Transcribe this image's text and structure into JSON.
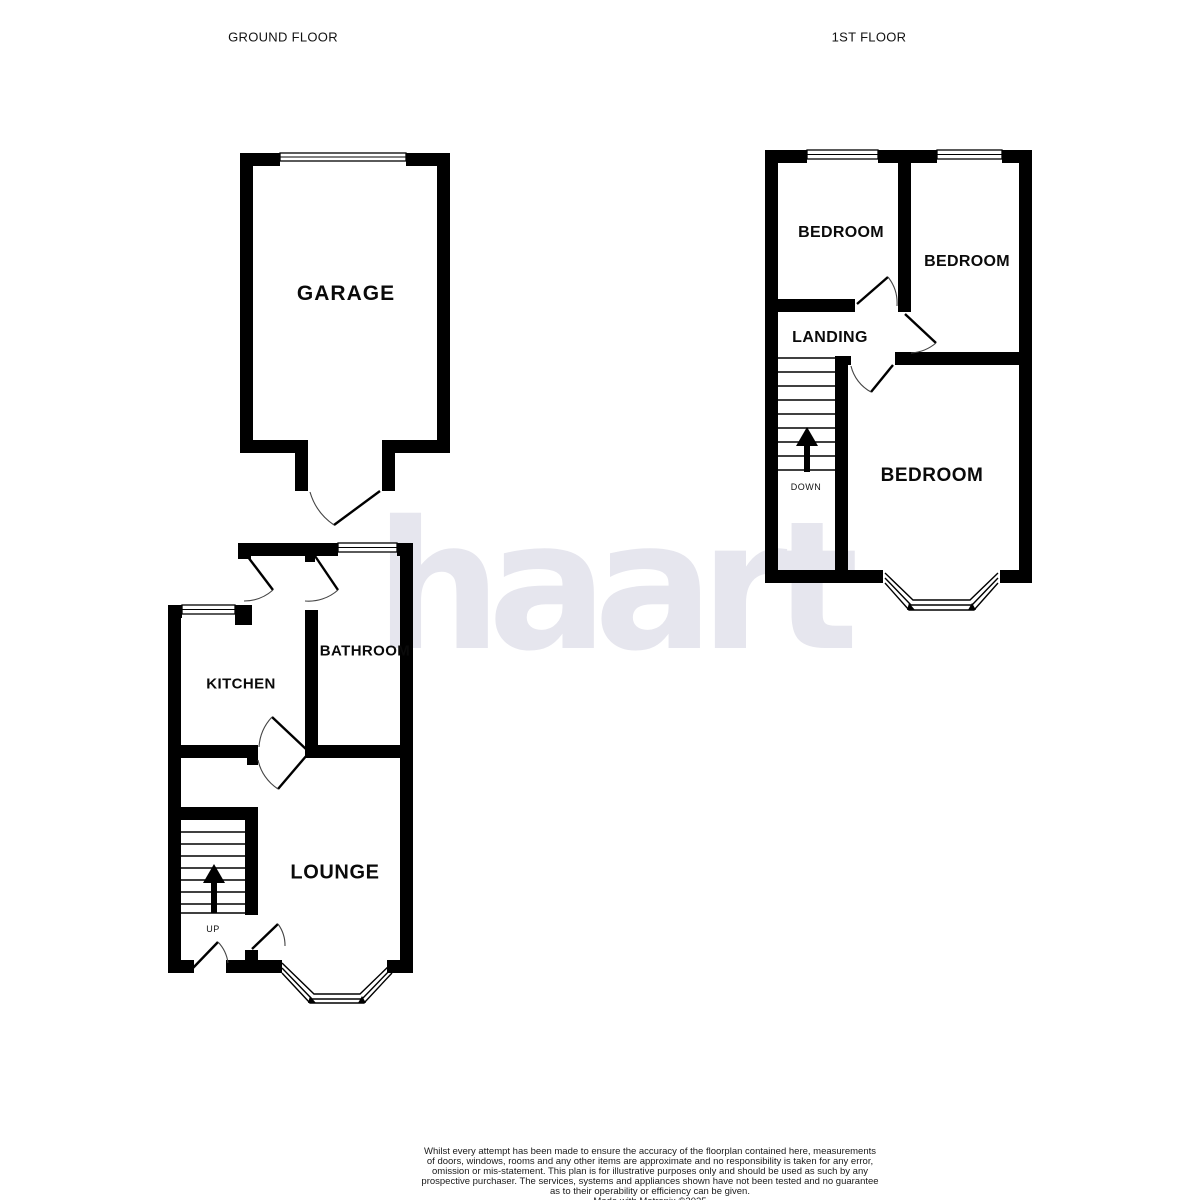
{
  "header": {
    "ground_floor": "GROUND FLOOR",
    "first_floor": "1ST FLOOR"
  },
  "watermark": {
    "text": "haart",
    "color": "#e6e6ee"
  },
  "colors": {
    "wall": "#000000",
    "background": "#ffffff",
    "door_swing": "#444444"
  },
  "ground_floor": {
    "rooms": {
      "garage": "GARAGE",
      "kitchen": "KITCHEN",
      "bathroom": "BATHROOM",
      "lounge": "LOUNGE"
    },
    "stairs": {
      "direction_label": "UP"
    }
  },
  "first_floor": {
    "rooms": {
      "bedroom_left": "BEDROOM",
      "bedroom_right": "BEDROOM",
      "bedroom_main": "BEDROOM",
      "landing": "LANDING"
    },
    "stairs": {
      "direction_label": "DOWN"
    }
  },
  "footer": {
    "disclaimer_lines": [
      "Whilst every attempt has been made to ensure the accuracy of the floorplan contained here, measurements",
      "of doors, windows, rooms and any other items are approximate and no responsibility is taken for any error,",
      "omission or mis-statement. This plan is for illustrative purposes only and should be used as such by any",
      "prospective purchaser. The services, systems and appliances shown have not been tested and no guarantee",
      "as to their operability or efficiency can be given.",
      "Made with Metropix ©2025"
    ]
  }
}
